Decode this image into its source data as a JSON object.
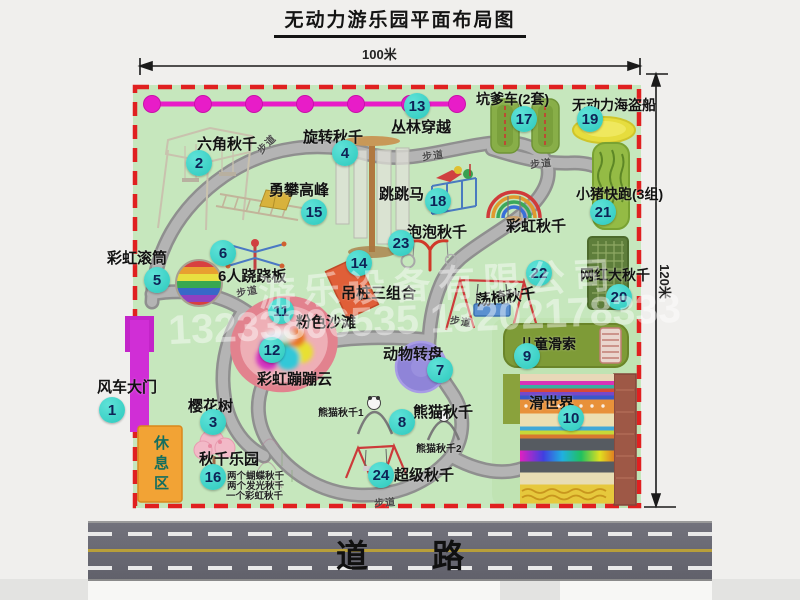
{
  "title": "无动力游乐园平面布局图",
  "dims": {
    "width": "100米",
    "height": "120米"
  },
  "road": {
    "label": "道路"
  },
  "map": {
    "path_label": "步道",
    "rest_area_label": "休息区",
    "rainbow_swing_label": "彩虹秋千"
  },
  "watermark": {
    "company": "游乐设备有限公司",
    "phone": "13233806535 13202178333"
  },
  "colors": {
    "badge": "#2EC9BD",
    "border_dashed": "#E02020",
    "map_bg": "#C6E7BD",
    "jungle_line": "#E81CC8",
    "road": "#686870",
    "rest_area_bg": "#F2A335"
  },
  "attractions": [
    {
      "num": "1",
      "label": "风车大门"
    },
    {
      "num": "2",
      "label": "六角秋千"
    },
    {
      "num": "3",
      "label": "樱花树"
    },
    {
      "num": "4",
      "label": "旋转秋千"
    },
    {
      "num": "5",
      "label": "彩虹滚筒"
    },
    {
      "num": "6",
      "label": "6人跷跷板"
    },
    {
      "num": "7",
      "label": "动物转盘"
    },
    {
      "num": "8",
      "label": "熊猫秋千",
      "sub1": "熊猫秋千1",
      "sub2": "熊猫秋千2"
    },
    {
      "num": "9",
      "label": "儿童滑索"
    },
    {
      "num": "10",
      "label": "滑世界"
    },
    {
      "num": "11",
      "label": "粉色沙滩"
    },
    {
      "num": "12",
      "label": "彩虹蹦蹦云"
    },
    {
      "num": "13",
      "label": "丛林穿越"
    },
    {
      "num": "14",
      "label": "吊桩三组合"
    },
    {
      "num": "15",
      "label": "勇攀高峰"
    },
    {
      "num": "16",
      "label": "秋千乐园",
      "notes": [
        "两个蝴蝶秋千",
        "两个发光秋千",
        "一个彩虹秋千"
      ]
    },
    {
      "num": "17",
      "label": "坑爹车(2套)"
    },
    {
      "num": "18",
      "label": "跳跳马"
    },
    {
      "num": "19",
      "label": "无动力海盗船"
    },
    {
      "num": "20",
      "label": "网红大秋千"
    },
    {
      "num": "21",
      "label": "小猪快跑(3组)"
    },
    {
      "num": "22",
      "label": "荡椅秋千"
    },
    {
      "num": "23",
      "label": "泡泡秋千"
    },
    {
      "num": "24",
      "label": "超级秋千"
    }
  ]
}
